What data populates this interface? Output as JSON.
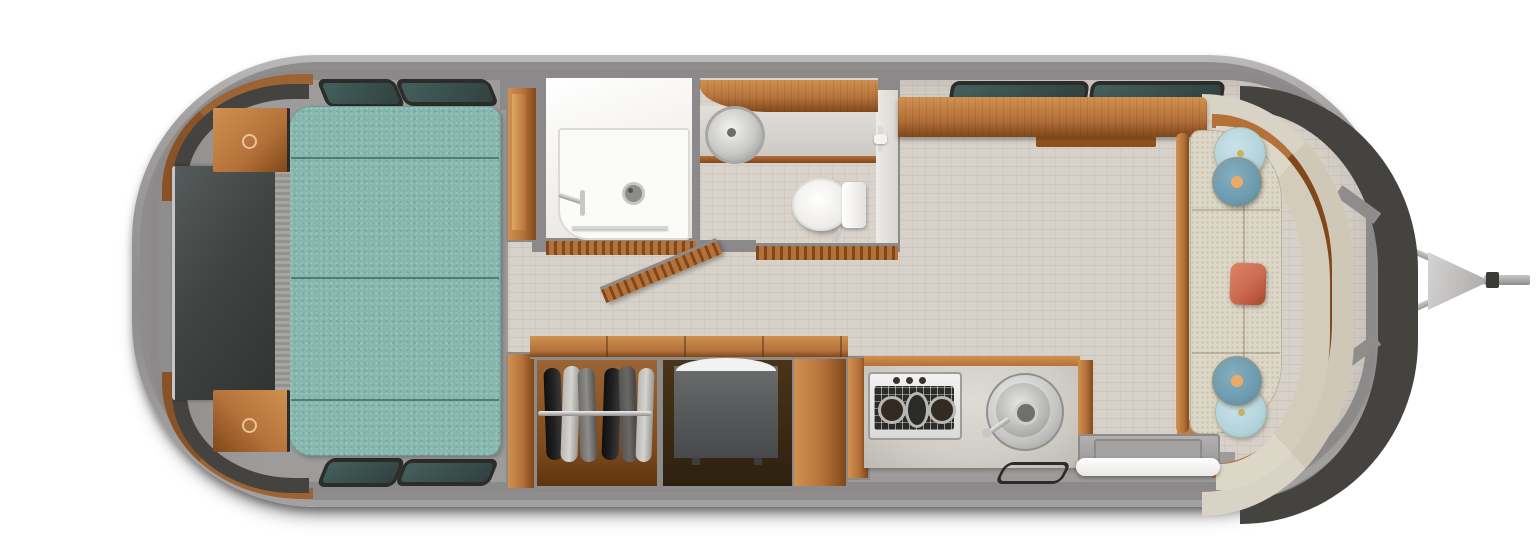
{
  "meta": {
    "title": "Travel trailer floor plan - overhead 3D view",
    "type": "floorplan-render",
    "orientation": "rear-left-hitch-right"
  },
  "palette": {
    "shell_outer": "#a3a1a0",
    "shell_mid": "#8f8d8c",
    "shell_rim": "#bdbbba",
    "wall": "#8b8989",
    "wall_dark": "#6f6d6c",
    "floor_tile": "#d8d1c9",
    "floor_gray": "#9e9c9b",
    "bed": "#86b7ae",
    "bed_seam": "#3f6f67",
    "wood": "#b5713a",
    "wood_light": "#cf9150",
    "wood_dark": "#80481a",
    "glass_dark": "#454340",
    "glass_teal": "#44605c",
    "tv_screen": "#3f4442",
    "white_room": "#f1efeb",
    "fixture": "#fbfbfa",
    "steel": "#d7d7d5",
    "steel_dark": "#8f8f8d",
    "counter": "#d0cdc6",
    "sofa": "#ddd7c8",
    "pillow_light": "#b3d3dc",
    "pillow_steel": "#6c9aae",
    "pillow_accent": "#ecaa69",
    "pillow_orange": "#cb6a4f",
    "clothes_dark": "#202020",
    "clothes_light": "#d6d4d0",
    "clothes_gray": "#8e8c88",
    "dresser": "#5b5d5e",
    "hitch": "#b7b5b4"
  },
  "regions": {
    "rear_bedroom": {
      "components": [
        "bed-teal-4-cushion",
        "tv-panel",
        "headboard",
        "nightstand-top",
        "nightstand-bottom",
        "corner-window-top",
        "corner-window-bottom",
        "wall-windows-top:2",
        "wall-windows-bottom:2",
        "head-side-cabinet"
      ]
    },
    "bathroom": {
      "components": [
        "shower-room",
        "shower-drain",
        "shower-faucet",
        "towel-bar",
        "vanity-wood-counter",
        "round-sink",
        "toilet",
        "toilet-tank",
        "paper-holder",
        "tambour-door-closed:2",
        "tambour-door-open"
      ]
    },
    "galley": {
      "components": [
        "overhead-cabinet",
        "overhead-shelf",
        "galley-windows:2",
        "wardrobe-with-hanging-clothes",
        "clothes-rod",
        "garments:6",
        "dresser-dark-cabinet",
        "kitchen-counter",
        "cooktop-3-burner",
        "kitchen-round-sink",
        "floor-vent",
        "entry-door-open",
        "entry-step-white"
      ]
    },
    "front_lounge": {
      "components": [
        "curved-sofa",
        "sofa-wood-trim",
        "sofa-left-rail",
        "round-pillow-light:2",
        "round-pillow-steel:2",
        "lumbar-pillow-orange",
        "front-wrap-windows:3"
      ]
    },
    "exterior": {
      "components": [
        "aluminum-shell",
        "a-frame-tongue",
        "coupler-triangle",
        "hitch-coupler-bar",
        "ground-shadow"
      ]
    }
  }
}
